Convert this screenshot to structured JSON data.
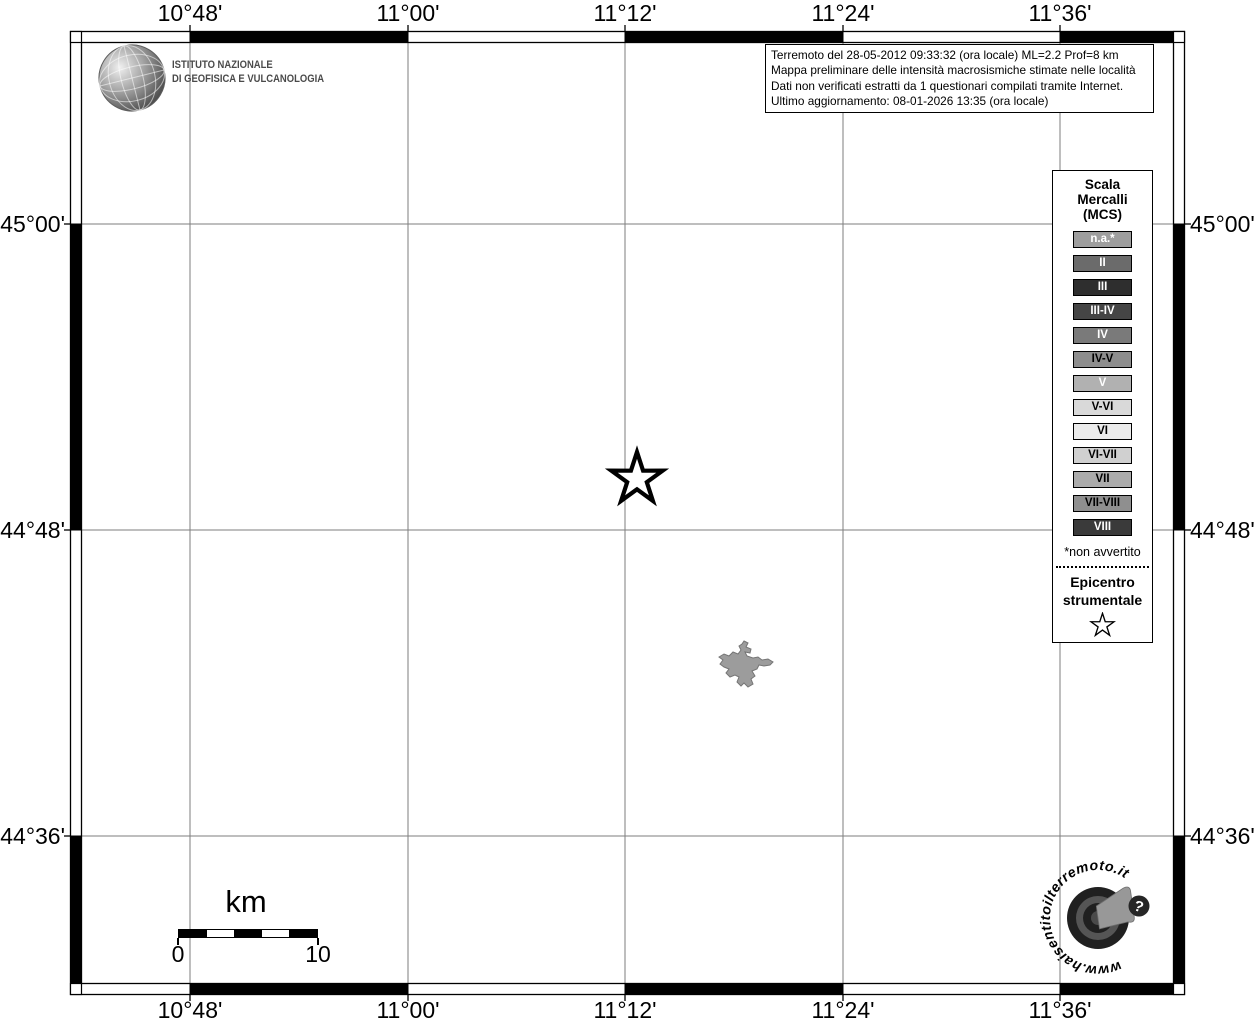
{
  "header": {
    "ingv_logo": {
      "line1": "ISTITUTO NAZIONALE",
      "line2": "DI GEOFISICA E VULCANOLOGIA"
    },
    "info_box": {
      "line1": "Terremoto del 28-05-2012 09:33:32 (ora locale) ML=2.2 Prof=8 km",
      "line2": "Mappa preliminare delle intensità macrosismiche stimate nelle località",
      "line3": "Dati non verificati estratti da 1 questionari compilati tramite Internet.",
      "line4": "Ultimo aggiornamento: 08-01-2026 13:35 (ora locale)"
    }
  },
  "axes": {
    "lon": [
      "10°48'",
      "11°00'",
      "11°12'",
      "11°24'",
      "11°36'"
    ],
    "lat": [
      "45°00'",
      "44°48'",
      "44°36'"
    ]
  },
  "legend": {
    "title_line1": "Scala",
    "title_line2": "Mercalli",
    "title_line3": "(MCS)",
    "items": [
      {
        "label": "n.a.*",
        "bg": "#9e9e9e",
        "fg": "#ffffff"
      },
      {
        "label": "II",
        "bg": "#6b6b6b",
        "fg": "#ffffff"
      },
      {
        "label": "III",
        "bg": "#2e2e2e",
        "fg": "#ffffff"
      },
      {
        "label": "III-IV",
        "bg": "#454545",
        "fg": "#ffffff"
      },
      {
        "label": "IV",
        "bg": "#7a7a7a",
        "fg": "#ffffff"
      },
      {
        "label": "IV-V",
        "bg": "#8d8d8d",
        "fg": "#000000"
      },
      {
        "label": "V",
        "bg": "#b1b1b1",
        "fg": "#ffffff"
      },
      {
        "label": "V-VI",
        "bg": "#d9d9d9",
        "fg": "#000000"
      },
      {
        "label": "VI",
        "bg": "#ebebeb",
        "fg": "#000000"
      },
      {
        "label": "VI-VII",
        "bg": "#d0d0d0",
        "fg": "#000000"
      },
      {
        "label": "VII",
        "bg": "#ababab",
        "fg": "#000000"
      },
      {
        "label": "VII-VIII",
        "bg": "#8f8f8f",
        "fg": "#000000"
      },
      {
        "label": "VIII",
        "bg": "#3a3a3a",
        "fg": "#ffffff"
      }
    ],
    "footnote": "*non avvertito",
    "epicenter_line1": "Epicentro",
    "epicenter_line2": "strumentale"
  },
  "scalebar": {
    "unit": "km",
    "start": "0",
    "end": "10"
  },
  "watermark": {
    "url_text": "www.haisentitoilterremoto.it",
    "question_mark": "?"
  }
}
